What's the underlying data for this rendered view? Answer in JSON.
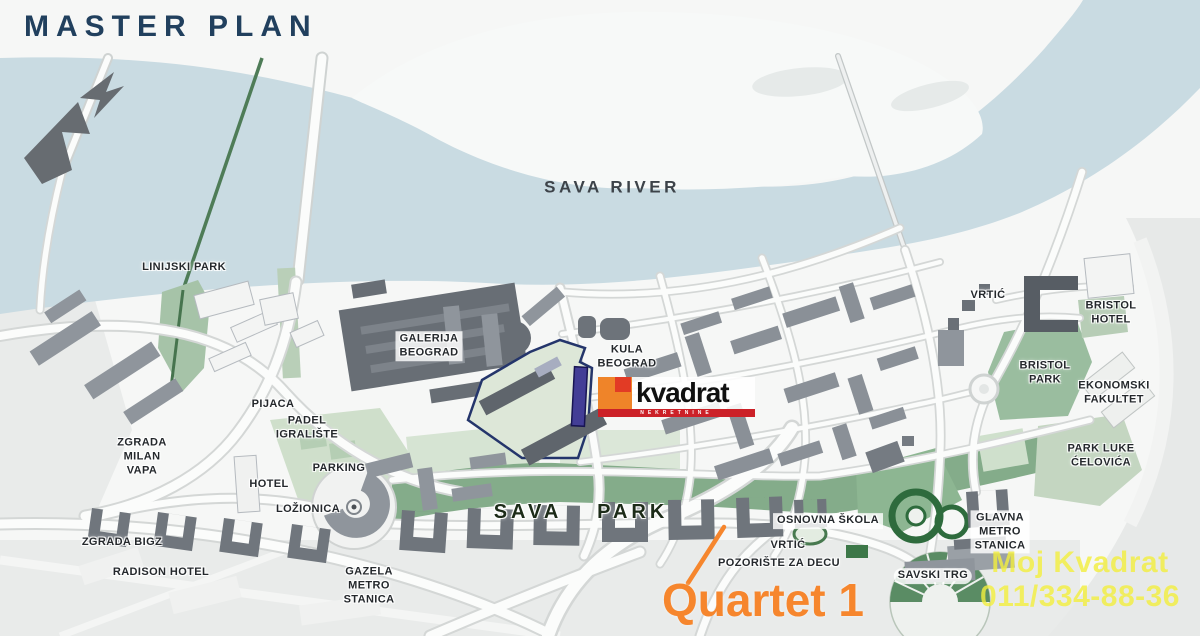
{
  "map_title": "MASTER PLAN",
  "river_label": "SAVA RIVER",
  "labels": {
    "linijski_park": "LINIJSKI PARK",
    "galerija_beograd": "GALERIJA\nBEOGRAD",
    "kula_beograd": "KULA\nBEOGRAD",
    "pijaca": "PIJACA",
    "padel_igraliste": "PADEL\nIGRALIŠTE",
    "zgrada_milan_vapa": "ZGRADA\nMILAN\nVAPA",
    "hotel": "HOTEL",
    "parking": "PARKING",
    "lozionica": "LOŽIONICA",
    "zgrada_bigz": "ZGRADA BIGZ",
    "radison_hotel": "RADISON HOTEL",
    "gazela_metro_stanica": "GAZELA\nMETRO\nSTANICA",
    "sava_park": "SAVA PARK",
    "osnovna_skola": "OSNOVNA ŠKOLA",
    "vrtic_center": "VRTIĆ",
    "pozoriste_za_decu": "POZORIŠTE ZA DECU",
    "savski_trg": "SAVSKI TRG",
    "glavna_metro_stanica": "GLAVNA\nMETRO\nSTANICA",
    "vrtic_north": "VRTIĆ",
    "bristol_hotel": "BRISTOL\nHOTEL",
    "bristol_park": "BRISTOL\nPARK",
    "ekonomski_fakultet": "EKONOMSKI\nFAKULTET",
    "park_luke_celovica": "PARK LUKE\nĆELOVIĆA"
  },
  "site": {
    "logo_text": "kvadrat",
    "logo_subtext": "NEKRETNINE"
  },
  "annotation": {
    "text": "Quartet 1"
  },
  "watermark": {
    "line1": "Moj Kvadrat",
    "line2": "011/334-88-36"
  },
  "colors": {
    "title_navy": "#21405e",
    "water": "#c9dbe2",
    "park_green": "#84ac8a",
    "light_green": "#d6e4d3",
    "building_gray": "#8f959c",
    "building_dark": "#676d74",
    "accent_orange": "#f6862d",
    "logo_orange": "#ef8429",
    "logo_red": "#cc2128",
    "site_outline_navy": "#24356b",
    "marker_purple": "#433e96",
    "watermark_yellow": "#f3ef3d"
  }
}
